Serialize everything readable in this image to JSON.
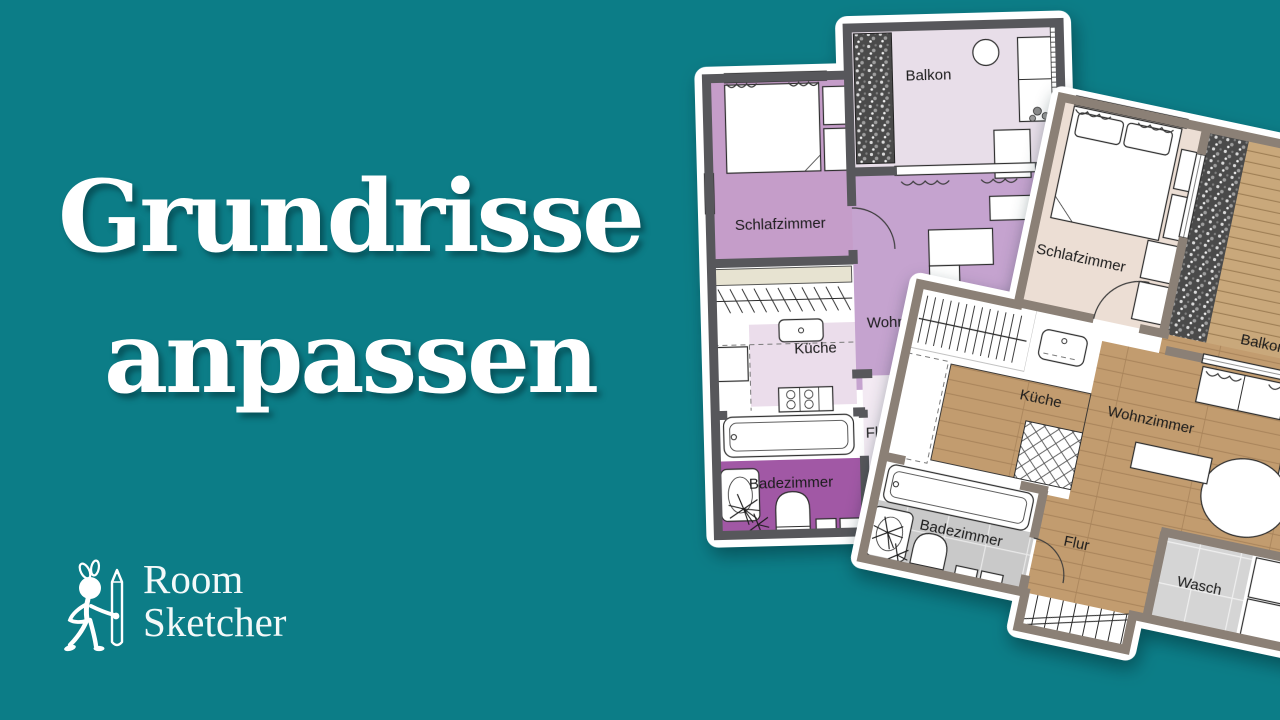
{
  "headline": {
    "line1": "Grundrisse",
    "line2": "anpassen"
  },
  "logo": {
    "name_line1": "Room",
    "name_line2": "Sketcher"
  },
  "colors": {
    "background": "#0C7D87",
    "headline_text": "#FFFFFF",
    "plan_a": {
      "wall": "#57575B",
      "schlafzimmer": "#C59DC9",
      "wohnzimmer": "#C5A3CF",
      "balkon": "#E8DEE9",
      "kueche": "#EBDDEB",
      "flur": "#F3EAF3",
      "badezimmer": "#A158A5",
      "closet_shelf": "#E7E3D1"
    },
    "plan_b": {
      "wall": "#8B8076",
      "schlafzimmer": "#ECDED4",
      "wood_floor": "#C29C6F",
      "deck": "#C9A87B",
      "tile": "#C9C9C9",
      "tile_light": "#D5D5D5"
    }
  },
  "plan_a": {
    "rooms": {
      "schlafzimmer": "Schlafzimmer",
      "balkon": "Balkon",
      "wohnzimmer": "Wohnzimmer",
      "kueche": "Küche",
      "flur": "Flur",
      "badezimmer": "Badezimmer"
    }
  },
  "plan_b": {
    "rooms": {
      "schlafzimmer": "Schlafzimmer",
      "balkon": "Balkon",
      "kueche": "Küche",
      "wohnzimmer": "Wohnzimmer",
      "flur": "Flur",
      "wasch": "Wasch",
      "badezimmer": "Badezimmer"
    }
  }
}
